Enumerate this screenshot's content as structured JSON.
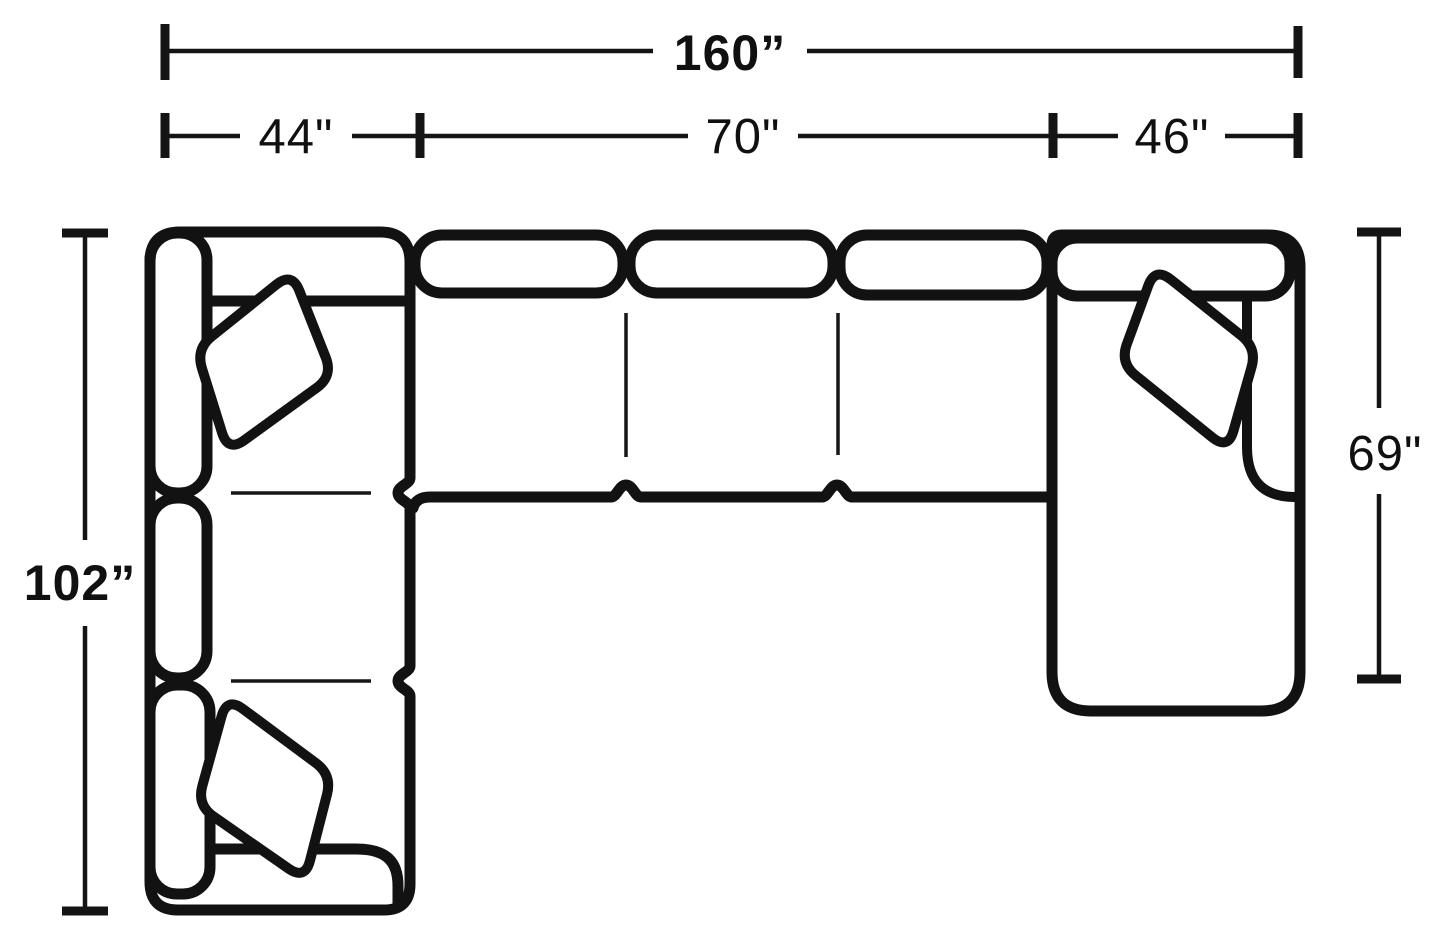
{
  "page": {
    "background": "#ffffff",
    "line_color": "#121212"
  },
  "diagram": {
    "type": "furniture-top-view-dimension-diagram",
    "subject": "three-piece sectional sofa with corner, armless sofa and chaise, shown from above with throw pillows",
    "unit": "inches",
    "dimensions": {
      "total_width": {
        "label": "160”",
        "value": 160
      },
      "section_widths": [
        {
          "name": "left-corner-section",
          "label": "44\"",
          "value": 44
        },
        {
          "name": "center-sofa-section",
          "label": "70\"",
          "value": 70
        },
        {
          "name": "right-chaise-section",
          "label": "46\"",
          "value": 46
        }
      ],
      "left_depth": {
        "label": "102”",
        "value": 102
      },
      "right_depth": {
        "label": "69\"",
        "value": 69
      }
    }
  }
}
